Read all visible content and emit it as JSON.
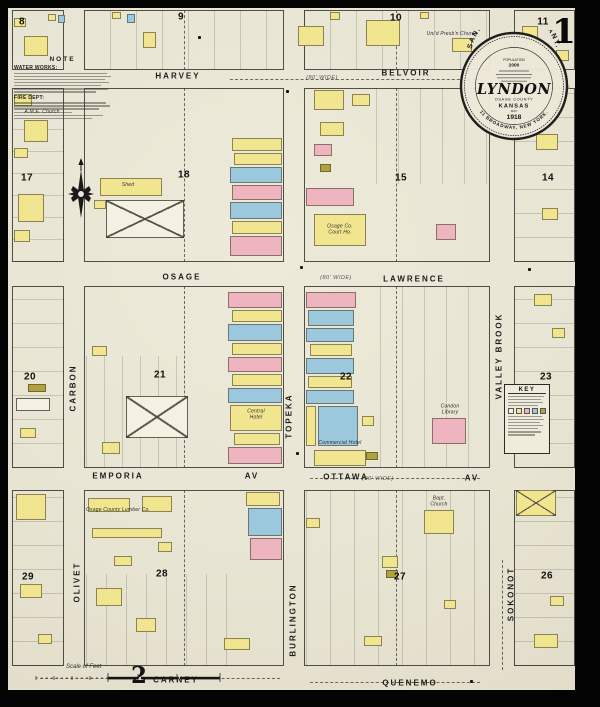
{
  "page": {
    "sheet_number": "1",
    "adjacent_sheet_reference": "2"
  },
  "seal": {
    "company": "SANBORN MAP COMPANY.",
    "population_label": "POPULATION",
    "population_value": "2000",
    "town": "LYNDON",
    "county": "OSAGE COUNTY",
    "state": "KANSAS",
    "month": "MAY",
    "year": "1918",
    "address": "11 BROADWAY, NEW YORK."
  },
  "note_box": {
    "title": "NOTE",
    "water_works": "WATER WORKS:",
    "fire_dept": "FIRE DEPT:"
  },
  "key_box": {
    "title": "KEY"
  },
  "scale_bar": {
    "label": "Scale of Feet"
  },
  "streets": {
    "horizontal": [
      {
        "name": "HARVEY",
        "x": 178,
        "y": 77,
        "note": "(80' WIDE)",
        "nx": 322,
        "ny": 78
      },
      {
        "name": "BELVOIR",
        "x": 406,
        "y": 74
      },
      {
        "name": "OSAGE",
        "x": 182,
        "y": 278,
        "note": "(80' WIDE)",
        "nx": 336,
        "ny": 278
      },
      {
        "name": "LAWRENCE",
        "x": 414,
        "y": 280
      },
      {
        "name": "EMPORIA",
        "x": 118,
        "y": 477
      },
      {
        "name": "AV",
        "x": 252,
        "y": 477
      },
      {
        "name": "OTTAWA",
        "x": 346,
        "y": 478,
        "note": "(80' WIDE)",
        "nx": 378,
        "ny": 479
      },
      {
        "name": "AV",
        "x": 472,
        "y": 479
      },
      {
        "name": "CARNEY",
        "x": 176,
        "y": 681
      },
      {
        "name": "QUENEMO",
        "x": 410,
        "y": 684
      }
    ],
    "vertical": [
      {
        "name": "CARBON",
        "x": 74,
        "y": 388
      },
      {
        "name": "TOPEKA",
        "x": 290,
        "y": 416
      },
      {
        "name": "BURLINGTON",
        "x": 294,
        "y": 620
      },
      {
        "name": "VALLEY BROOK",
        "x": 500,
        "y": 356
      },
      {
        "name": "OLIVET",
        "x": 78,
        "y": 582
      },
      {
        "name": "SOKONOT",
        "x": 512,
        "y": 594
      }
    ]
  },
  "blocks": [
    {
      "number": "8",
      "rect": [
        12,
        10,
        52,
        60
      ],
      "num_pos": [
        22,
        22
      ]
    },
    {
      "number": "9",
      "rect": [
        84,
        10,
        200,
        60
      ],
      "num_pos": [
        181,
        17
      ]
    },
    {
      "number": "10",
      "rect": [
        304,
        10,
        186,
        60
      ],
      "num_pos": [
        396,
        18
      ]
    },
    {
      "number": "11",
      "rect": [
        514,
        10,
        61,
        60
      ],
      "num_pos": [
        543,
        22
      ]
    },
    {
      "number": "17",
      "rect": [
        12,
        88,
        52,
        174
      ],
      "num_pos": [
        27,
        178
      ]
    },
    {
      "number": "18",
      "rect": [
        84,
        88,
        200,
        174
      ],
      "num_pos": [
        184,
        175
      ]
    },
    {
      "number": "15",
      "rect": [
        304,
        88,
        186,
        174
      ],
      "num_pos": [
        401,
        178
      ]
    },
    {
      "number": "14",
      "rect": [
        514,
        88,
        61,
        174
      ],
      "num_pos": [
        548,
        178
      ]
    },
    {
      "number": "20",
      "rect": [
        12,
        286,
        52,
        182
      ],
      "num_pos": [
        30,
        377
      ]
    },
    {
      "number": "21",
      "rect": [
        84,
        286,
        200,
        182
      ],
      "num_pos": [
        160,
        375
      ]
    },
    {
      "number": "22",
      "rect": [
        304,
        286,
        186,
        182
      ],
      "num_pos": [
        346,
        377
      ]
    },
    {
      "number": "23",
      "rect": [
        514,
        286,
        61,
        182
      ],
      "num_pos": [
        546,
        377
      ]
    },
    {
      "number": "29",
      "rect": [
        12,
        490,
        52,
        176
      ],
      "num_pos": [
        28,
        577
      ]
    },
    {
      "number": "28",
      "rect": [
        84,
        490,
        200,
        176
      ],
      "num_pos": [
        162,
        574
      ]
    },
    {
      "number": "27",
      "rect": [
        304,
        490,
        186,
        176
      ],
      "num_pos": [
        400,
        577
      ]
    },
    {
      "number": "26",
      "rect": [
        514,
        490,
        61,
        176
      ],
      "num_pos": [
        547,
        576
      ]
    }
  ],
  "landmarks": [
    {
      "text": "Uni'd Presb'n Church",
      "x": 452,
      "y": 35,
      "style": "plain"
    },
    {
      "text": "City Shops",
      "x": 556,
      "y": 88,
      "style": "faded"
    },
    {
      "text": "A.M.E. Church",
      "x": 42,
      "y": 113,
      "style": "plain"
    },
    {
      "text": "Shed",
      "x": 128,
      "y": 186,
      "style": "plain"
    },
    {
      "text": "Osage Co.\nCourt Ho.",
      "x": 340,
      "y": 230,
      "style": "plain"
    },
    {
      "text": "Central\nHotel",
      "x": 256,
      "y": 415,
      "style": "plain"
    },
    {
      "text": "Commercial Hotel",
      "x": 340,
      "y": 444,
      "style": "plain"
    },
    {
      "text": "Condon\nLibrary",
      "x": 450,
      "y": 410,
      "style": "plain"
    },
    {
      "text": "Bapt.\nChurch",
      "x": 439,
      "y": 502,
      "style": "plain"
    },
    {
      "text": "Osage County Lumber Co.",
      "x": 118,
      "y": 511,
      "style": "plain"
    }
  ],
  "buildings": [
    [
      24,
      36,
      24,
      20,
      "y"
    ],
    [
      14,
      18,
      12,
      9,
      "y"
    ],
    [
      48,
      14,
      8,
      7,
      "y"
    ],
    [
      58,
      15,
      7,
      8,
      "b"
    ],
    [
      112,
      12,
      9,
      7,
      "y"
    ],
    [
      127,
      14,
      8,
      9,
      "b"
    ],
    [
      143,
      32,
      13,
      16,
      "y"
    ],
    [
      298,
      26,
      26,
      20,
      "y"
    ],
    [
      366,
      20,
      34,
      26,
      "y"
    ],
    [
      330,
      12,
      10,
      8,
      "y"
    ],
    [
      420,
      12,
      9,
      7,
      "y"
    ],
    [
      452,
      38,
      20,
      14,
      "y"
    ],
    [
      522,
      26,
      16,
      17,
      "y"
    ],
    [
      556,
      50,
      13,
      11,
      "y"
    ],
    [
      14,
      94,
      18,
      12,
      "y"
    ],
    [
      24,
      120,
      24,
      22,
      "y"
    ],
    [
      14,
      148,
      14,
      10,
      "y"
    ],
    [
      18,
      194,
      26,
      28,
      "y"
    ],
    [
      14,
      230,
      16,
      12,
      "y"
    ],
    [
      100,
      178,
      62,
      18,
      "y"
    ],
    [
      94,
      200,
      12,
      9,
      "y"
    ],
    [
      106,
      200,
      78,
      38,
      "w",
      "x"
    ],
    [
      232,
      138,
      50,
      13,
      "y"
    ],
    [
      234,
      153,
      48,
      12,
      "y"
    ],
    [
      230,
      167,
      52,
      16,
      "b"
    ],
    [
      232,
      185,
      50,
      15,
      "p"
    ],
    [
      230,
      202,
      52,
      17,
      "b"
    ],
    [
      232,
      221,
      50,
      13,
      "y"
    ],
    [
      230,
      236,
      52,
      20,
      "p"
    ],
    [
      314,
      90,
      30,
      20,
      "y"
    ],
    [
      352,
      94,
      18,
      12,
      "y"
    ],
    [
      320,
      122,
      24,
      14,
      "y"
    ],
    [
      314,
      144,
      18,
      12,
      "p"
    ],
    [
      320,
      164,
      11,
      8,
      "o"
    ],
    [
      306,
      188,
      48,
      18,
      "p"
    ],
    [
      314,
      214,
      52,
      32,
      "y"
    ],
    [
      436,
      224,
      20,
      16,
      "p"
    ],
    [
      536,
      134,
      22,
      16,
      "y"
    ],
    [
      542,
      208,
      16,
      12,
      "y"
    ],
    [
      28,
      384,
      18,
      8,
      "o"
    ],
    [
      16,
      398,
      34,
      13,
      "w"
    ],
    [
      20,
      428,
      16,
      10,
      "y"
    ],
    [
      92,
      346,
      15,
      10,
      "y"
    ],
    [
      126,
      396,
      62,
      42,
      "w",
      "x"
    ],
    [
      102,
      442,
      18,
      12,
      "y"
    ],
    [
      228,
      292,
      54,
      16,
      "p"
    ],
    [
      232,
      310,
      50,
      12,
      "y"
    ],
    [
      228,
      324,
      54,
      17,
      "b"
    ],
    [
      232,
      343,
      50,
      12,
      "y"
    ],
    [
      228,
      357,
      54,
      15,
      "p"
    ],
    [
      232,
      374,
      50,
      12,
      "y"
    ],
    [
      228,
      388,
      54,
      15,
      "b"
    ],
    [
      230,
      405,
      52,
      26,
      "y"
    ],
    [
      234,
      433,
      46,
      12,
      "y"
    ],
    [
      228,
      447,
      54,
      17,
      "p"
    ],
    [
      306,
      292,
      50,
      16,
      "p"
    ],
    [
      308,
      310,
      46,
      16,
      "b"
    ],
    [
      306,
      328,
      48,
      14,
      "b"
    ],
    [
      310,
      344,
      42,
      12,
      "y"
    ],
    [
      306,
      358,
      48,
      16,
      "b"
    ],
    [
      308,
      376,
      44,
      12,
      "y"
    ],
    [
      306,
      390,
      48,
      14,
      "b"
    ],
    [
      306,
      406,
      10,
      40,
      "y"
    ],
    [
      318,
      406,
      40,
      40,
      "b"
    ],
    [
      362,
      416,
      12,
      10,
      "y"
    ],
    [
      314,
      450,
      52,
      16,
      "y"
    ],
    [
      432,
      418,
      34,
      26,
      "p"
    ],
    [
      366,
      452,
      12,
      8,
      "o"
    ],
    [
      534,
      294,
      18,
      12,
      "y"
    ],
    [
      552,
      328,
      13,
      10,
      "y"
    ],
    [
      16,
      494,
      30,
      26,
      "y"
    ],
    [
      20,
      584,
      22,
      14,
      "y"
    ],
    [
      38,
      634,
      14,
      10,
      "y"
    ],
    [
      88,
      498,
      42,
      14,
      "y"
    ],
    [
      142,
      496,
      30,
      16,
      "y"
    ],
    [
      92,
      528,
      70,
      10,
      "y"
    ],
    [
      158,
      542,
      14,
      10,
      "y"
    ],
    [
      114,
      556,
      18,
      10,
      "y"
    ],
    [
      96,
      588,
      26,
      18,
      "y"
    ],
    [
      136,
      618,
      20,
      14,
      "y"
    ],
    [
      224,
      638,
      26,
      12,
      "y"
    ],
    [
      246,
      492,
      34,
      14,
      "y"
    ],
    [
      248,
      508,
      34,
      28,
      "b"
    ],
    [
      250,
      538,
      32,
      22,
      "p"
    ],
    [
      306,
      518,
      14,
      10,
      "y"
    ],
    [
      424,
      510,
      30,
      24,
      "y"
    ],
    [
      382,
      556,
      16,
      12,
      "y"
    ],
    [
      386,
      570,
      12,
      8,
      "o"
    ],
    [
      364,
      636,
      18,
      10,
      "y"
    ],
    [
      444,
      600,
      12,
      9,
      "y"
    ],
    [
      516,
      490,
      40,
      26,
      "y",
      "x"
    ],
    [
      550,
      596,
      14,
      10,
      "y"
    ],
    [
      534,
      634,
      24,
      14,
      "y"
    ]
  ],
  "lot_strips": [
    [
      12,
      88,
      52,
      174,
      "h",
      22
    ],
    [
      12,
      286,
      52,
      182,
      "h",
      24
    ],
    [
      12,
      490,
      52,
      176,
      "h",
      24
    ],
    [
      514,
      88,
      61,
      174,
      "h",
      24
    ],
    [
      514,
      286,
      61,
      182,
      "h",
      24
    ],
    [
      514,
      490,
      61,
      176,
      "h",
      24
    ],
    [
      84,
      10,
      200,
      60,
      "v",
      26
    ],
    [
      304,
      10,
      186,
      60,
      "v",
      26
    ],
    [
      376,
      88,
      114,
      96,
      "v",
      22
    ],
    [
      86,
      356,
      100,
      112,
      "v",
      18
    ],
    [
      380,
      286,
      110,
      182,
      "v",
      22
    ],
    [
      306,
      490,
      184,
      176,
      "v",
      24
    ],
    [
      86,
      574,
      158,
      92,
      "v",
      20
    ]
  ],
  "alley_dashes": [
    [
      "v",
      184,
      10,
      60
    ],
    [
      "v",
      184,
      88,
      174
    ],
    [
      "v",
      184,
      286,
      182
    ],
    [
      "v",
      184,
      490,
      176
    ],
    [
      "v",
      396,
      10,
      60
    ],
    [
      "v",
      396,
      88,
      174
    ],
    [
      "v",
      396,
      286,
      182
    ],
    [
      "v",
      396,
      490,
      176
    ],
    [
      "h",
      230,
      79,
      250
    ],
    [
      "h",
      310,
      478,
      170
    ],
    [
      "h",
      40,
      678,
      240
    ],
    [
      "h",
      310,
      682,
      170
    ],
    [
      "v",
      502,
      560,
      110
    ]
  ],
  "hydrants": [
    [
      286,
      90
    ],
    [
      300,
      266
    ],
    [
      528,
      268
    ],
    [
      296,
      452
    ],
    [
      470,
      680
    ],
    [
      198,
      36
    ],
    [
      528,
      96
    ]
  ],
  "colors": {
    "paper": "#e9e5d4",
    "yellow": "#f2e58f",
    "pink": "#eeb5c0",
    "blue": "#9cc8de",
    "olive": "#b0a23c",
    "ink": "#1c1c1c"
  }
}
